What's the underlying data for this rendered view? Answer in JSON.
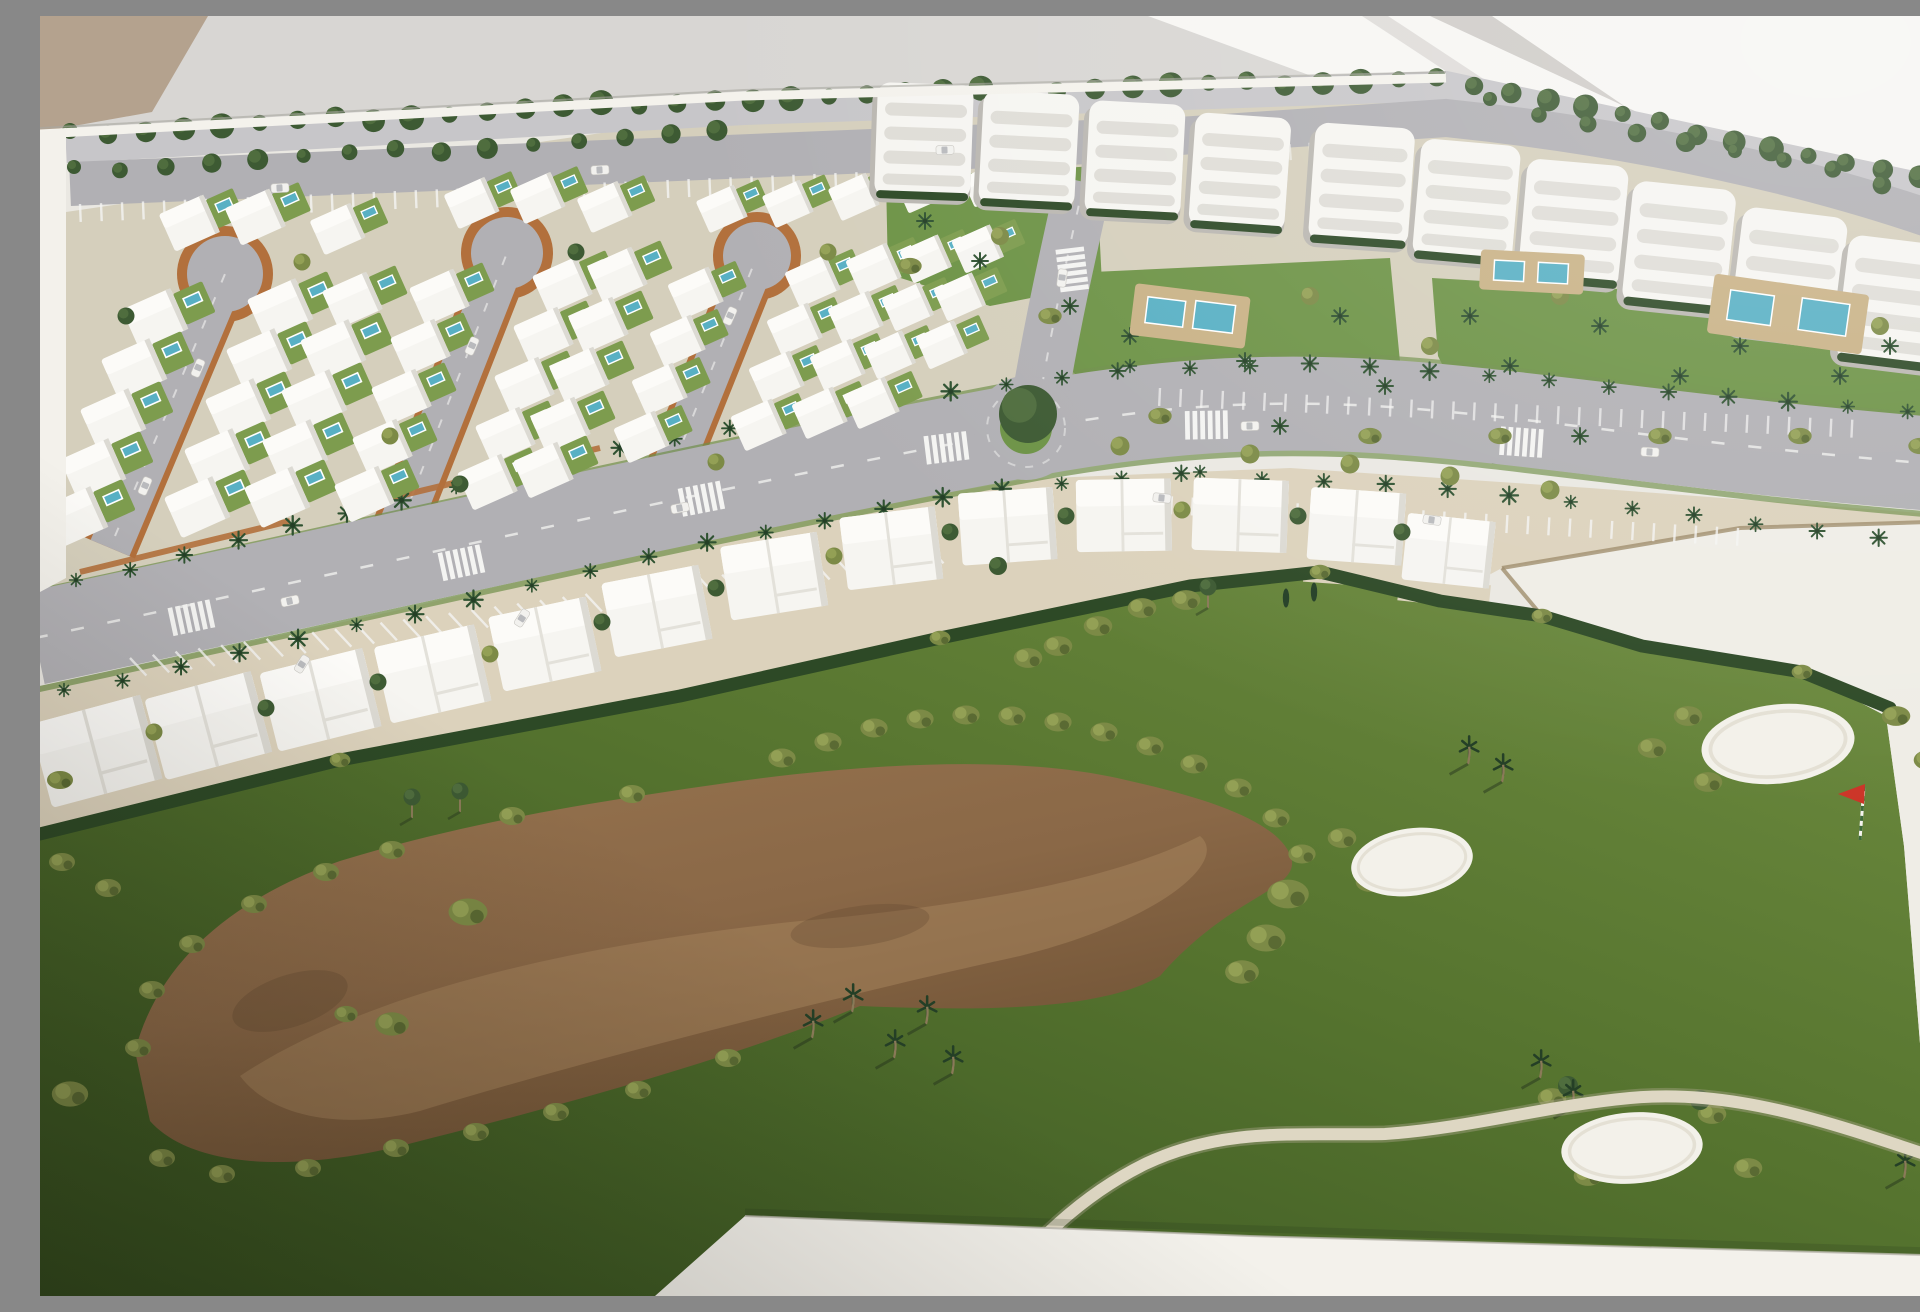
{
  "scene": {
    "domain": "Natural-Image",
    "subject": "Aerial photograph of an architectural scale model (maquette) of a golf-resort residential masterplan: white villa blocks with private blue pools arranged around terracotta-edged loop streets, a palm-lined main avenue with a roundabout, a long row of white apartment buildings with communal pool gardens, a curved row of townhouses facing a golf course with a large brown waste area, white sand bunkers and a red pin flag, all built on a white baseboard photographed under indoor window light.",
    "no_text_visible": true
  },
  "colors": {
    "wall_bg": "#d8d6d3",
    "wall_tan": "#b4a28e",
    "wall_bright": "#f7f6f3",
    "wall_stripe": "#cfccc8",
    "base_white": "#eae8e2",
    "base_edge": "#f3f1eb",
    "ground_sand": "#d5cfbc",
    "ground_patio": "#dcd2bc",
    "plot_white": "#efede6",
    "plot_edge": "#9c8a68",
    "road_gray": "#b1b0b4",
    "road_light": "#c7c6c9",
    "curb_terracotta": "#b2703c",
    "marking_white": "#f4f4f2",
    "lawn_green": "#7d9c4e",
    "garden_green": "#6d9346",
    "grass_light": "#708e41",
    "grass_mid": "#56742f",
    "grass_dark": "#334e1e",
    "hedge_dark": "#2d4926",
    "tree_dark": "#3d5a33",
    "tree_dark_hi": "#4f6d3e",
    "tree_olive": "#7c8a46",
    "tree_olive_hi": "#93a055",
    "tree_olive_dk": "#5a6a33",
    "palm_green": "#2f5231",
    "palm_dark": "#243f26",
    "trunk_brown": "#8a7a58",
    "waste_brown": "#8a6847",
    "waste_light": "#a7855e",
    "waste_dark": "#5e452d",
    "pool_blue": "#58b0c4",
    "pool_deck": "#c9b286",
    "building_white": "#f6f5f1",
    "building_hi": "#fcfbf8",
    "building_shade": "#dcdad3",
    "apt_slot": "#dfddd7",
    "apt_shadow": "#bab7b1",
    "sand_white": "#f3f1ea",
    "sand_shade": "#d5cfbd",
    "path_cream": "#ded7c3",
    "flag_red": "#cc3528",
    "car_white": "#f2f1ee",
    "car_glass": "#b9babd"
  },
  "inventory": {
    "villas_with_pools": 60,
    "loop_streets": 3,
    "apartment_blocks": 11,
    "communal_pool_gardens": 3,
    "townhouses": 13,
    "roundabouts": 1,
    "main_avenues": 1,
    "sand_bunkers": 4,
    "waste_areas": 1,
    "pin_flags": 1,
    "cart_paths": 1,
    "cars": 16
  }
}
